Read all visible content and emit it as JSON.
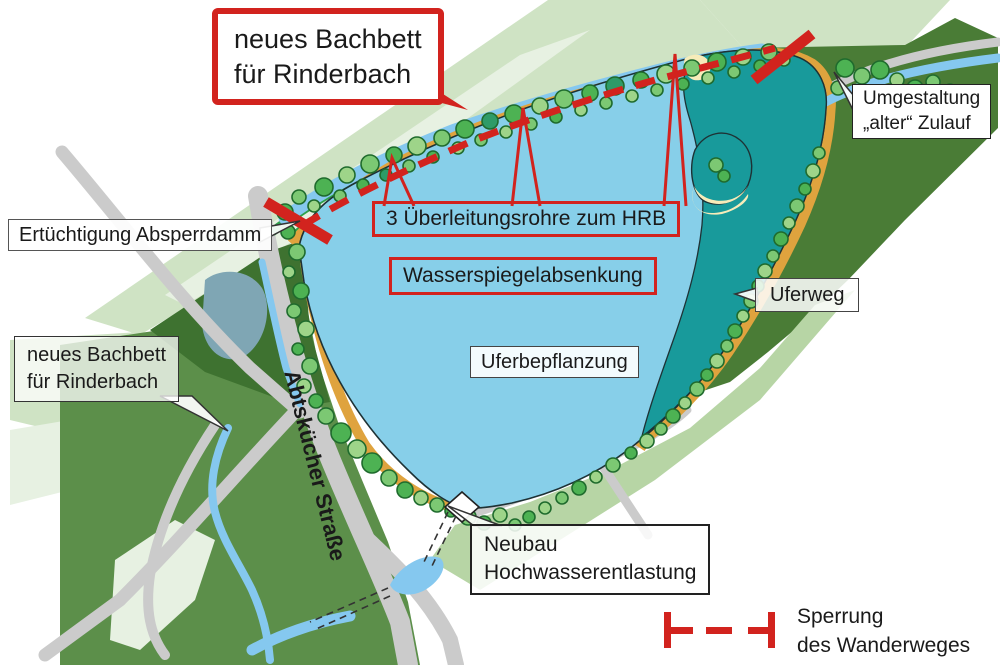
{
  "title": "Site plan of flood retention basin (HRB) with construction measures",
  "colors": {
    "lake": "#87CFE9",
    "teal": "#189A9B",
    "sand": "#F6ECB9",
    "stream": "#85C8EF",
    "path_orange": "#DFA33E",
    "green_strip": "#2FA14B",
    "pale_green": "#CFE3C4",
    "paler_green": "#E7F1E2",
    "field_green": "#5C8F4A",
    "forest_green": "#4A7C36",
    "dark_green": "#3E7230",
    "bank_green": "#B7D5A5",
    "road_gray": "#CBCBCB",
    "red": "#D2231E",
    "tree_a": "#4DB253",
    "tree_b": "#7CC873",
    "tree_c": "#9ED489",
    "tree_dark": "#2E9B68",
    "tree_stroke": "#1F6B2D",
    "pond_muted": "#7FA6B4",
    "outline": "#1E3235",
    "text": "#1A1A1A"
  },
  "labels": {
    "new_bed_callout": {
      "line1": "neues Bachbett",
      "line2": "für Rinderbach"
    },
    "old_inflow": {
      "line1": "Umgestaltung",
      "line2": "„alter“ Zulauf"
    },
    "dam": "Ertüchtigung Absperrdamm",
    "transfer_pipes": "3 Überleitungsrohre zum HRB",
    "water_level": "Wasserspiegelabsenkung",
    "shore_path": "Uferweg",
    "shore_planting": "Uferbepflanzung",
    "new_bed_map": {
      "line1": "neues Bachbett",
      "line2": "für Rinderbach"
    },
    "street": "Abtskücher Straße",
    "spillway": {
      "line1": "Neubau",
      "line2": "Hochwasserentlastung"
    }
  },
  "legend": {
    "symbol": "trail-closure-dashed-line",
    "item": {
      "line1": "Sperrung",
      "line2": "des Wanderweges"
    }
  }
}
